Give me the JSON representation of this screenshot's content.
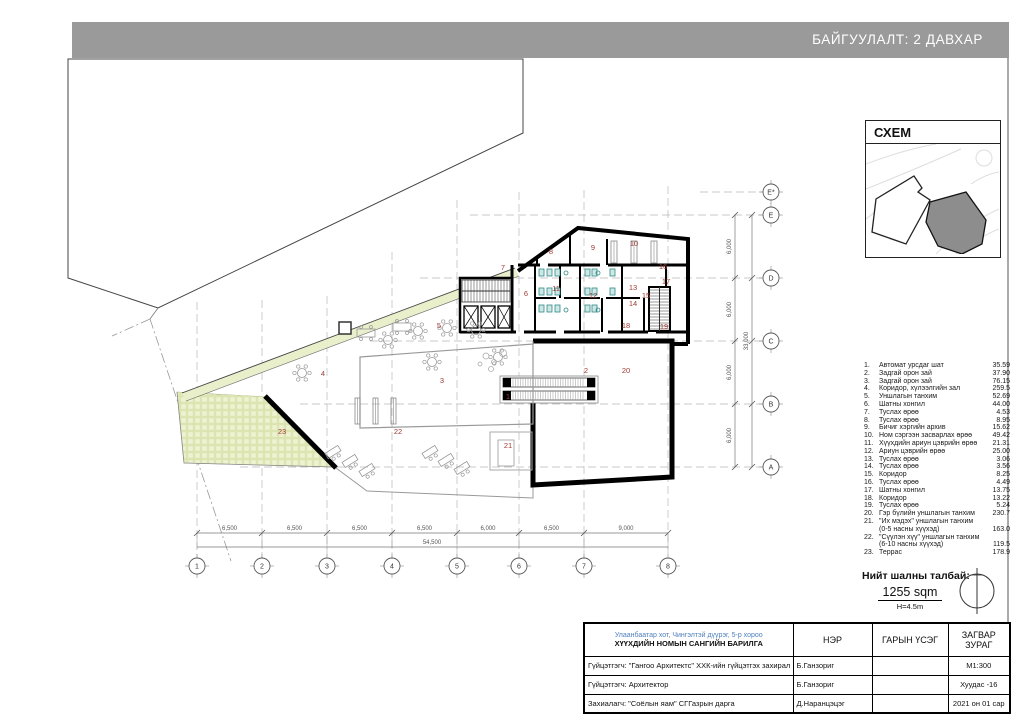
{
  "header": {
    "title": "БАЙГУУЛАЛТ:  2 ДАВХАР"
  },
  "schem": {
    "title": "СХЕМ"
  },
  "legend": {
    "items": [
      {
        "no": "1.",
        "name": "Автомат урсдаг шат",
        "area": "35.59"
      },
      {
        "no": "2.",
        "name": "Задгай орон зай",
        "area": "37.90"
      },
      {
        "no": "3.",
        "name": "Задгай орон зай",
        "area": "76.15"
      },
      {
        "no": "4.",
        "name": "Коридор, хүлээлгийн зал",
        "area": "259.5"
      },
      {
        "no": "5.",
        "name": "Уншлагын танхим",
        "area": "52.69"
      },
      {
        "no": "6.",
        "name": "Шатны хонгил",
        "area": "44.00"
      },
      {
        "no": "7.",
        "name": "Туслах өрөө",
        "area": "4.53"
      },
      {
        "no": "8.",
        "name": "Туслах өрөө",
        "area": "8.95"
      },
      {
        "no": "9.",
        "name": "Бичиг хэргийн архив",
        "area": "15.62"
      },
      {
        "no": "10.",
        "name": "Ном сэргээн засварлах өрөө",
        "area": "49.42"
      },
      {
        "no": "11.",
        "name": "Хүүхдийн ариун цэврийн өрөө",
        "area": "21.31"
      },
      {
        "no": "12.",
        "name": "Ариун цэврийн өрөө",
        "area": "25.00"
      },
      {
        "no": "13.",
        "name": "Туслах өрөө",
        "area": "3.06"
      },
      {
        "no": "14.",
        "name": "Туслах өрөө",
        "area": "3.56"
      },
      {
        "no": "15.",
        "name": "Коридор",
        "area": "8.25"
      },
      {
        "no": "16.",
        "name": "Туслах өрөө",
        "area": "4.49"
      },
      {
        "no": "17.",
        "name": "Шатны хонгил",
        "area": "13.75"
      },
      {
        "no": "18.",
        "name": "Коридор",
        "area": "13.22"
      },
      {
        "no": "19.",
        "name": "Туслах өрөө",
        "area": "5.24"
      },
      {
        "no": "20.",
        "name": "Гэр бүлийн уншлагын танхим",
        "area": "230.7"
      },
      {
        "no": "21.",
        "name": "\"Их мэдэх\" уншлагын танхим",
        "sub": "(0-5 насны хүүхэд)",
        "area": "163.0"
      },
      {
        "no": "22.",
        "name": "\"Сүүлэн хүү\" уншлагын танхим",
        "sub": "(6-10 насны хүүхэд)",
        "area": "119.5"
      },
      {
        "no": "23.",
        "name": "Террас",
        "area": "178.9"
      }
    ]
  },
  "total": {
    "label": "Нийт шалны талбай:",
    "area": "1255 sqm",
    "height": "H=4.5m"
  },
  "titleblock": {
    "address": "Улаанбаатар хот, Чингэлтэй дүүрэг, 5-р хороо",
    "project": "ХҮҮХДИЙН НОМЫН САНГИЙН БАРИЛГА",
    "col_name": "НЭР",
    "col_sign": "ГАРЫН ҮСЭГ",
    "col_type1": "ЗАГВАР",
    "col_type2": "ЗУРАГ",
    "rows": [
      {
        "role": "Гүйцэтгэгч: \"Гангоо Архитектс\" ХХК-ийн гүйцэтгэх захирал",
        "name": "Б.Ганзориг",
        "sign": "",
        "right": "М1:300"
      },
      {
        "role": "Гүйцэтгэгч: Архитектор",
        "name": "Б.Ганзориг",
        "sign": "",
        "right": "Хуудас -16"
      },
      {
        "role": "Захиалагч: \"Соёлын яам\" СГГазрын дарга",
        "name": "Д.Наранцэцэг",
        "sign": "",
        "right": "2021 он 01 сар"
      }
    ]
  },
  "plan": {
    "grid_cols": [
      {
        "label": "1",
        "x": 197
      },
      {
        "label": "2",
        "x": 262
      },
      {
        "label": "3",
        "x": 327
      },
      {
        "label": "4",
        "x": 392
      },
      {
        "label": "5",
        "x": 457
      },
      {
        "label": "6",
        "x": 519
      },
      {
        "label": "7",
        "x": 584
      },
      {
        "label": "8",
        "x": 668
      }
    ],
    "grid_rows": [
      {
        "label": "E*",
        "y": 192
      },
      {
        "label": "E",
        "y": 215
      },
      {
        "label": "D",
        "y": 278
      },
      {
        "label": "C",
        "y": 341
      },
      {
        "label": "B",
        "y": 404
      },
      {
        "label": "A",
        "y": 467
      }
    ],
    "dims_bottom": [
      "6,500",
      "6,500",
      "6,500",
      "6,500",
      "6,000",
      "6,500",
      "9,000"
    ],
    "dim_total_bottom": "54,500",
    "dims_right": [
      "6,000",
      "6,000",
      "6,000",
      "6,000"
    ],
    "dim_total_right": "33,000",
    "room_labels": [
      {
        "no": "1",
        "x": 508,
        "y": 399
      },
      {
        "no": "2",
        "x": 586,
        "y": 373
      },
      {
        "no": "3",
        "x": 442,
        "y": 383
      },
      {
        "no": "4",
        "x": 323,
        "y": 376
      },
      {
        "no": "5",
        "x": 439,
        "y": 328
      },
      {
        "no": "6",
        "x": 526,
        "y": 296
      },
      {
        "no": "7",
        "x": 503,
        "y": 270
      },
      {
        "no": "8",
        "x": 551,
        "y": 254
      },
      {
        "no": "9",
        "x": 593,
        "y": 250
      },
      {
        "no": "10",
        "x": 634,
        "y": 246
      },
      {
        "no": "11",
        "x": 556,
        "y": 291
      },
      {
        "no": "12",
        "x": 593,
        "y": 298
      },
      {
        "no": "13",
        "x": 633,
        "y": 290
      },
      {
        "no": "14",
        "x": 633,
        "y": 306
      },
      {
        "no": "15",
        "x": 646,
        "y": 298
      },
      {
        "no": "16",
        "x": 663,
        "y": 269
      },
      {
        "no": "17",
        "x": 666,
        "y": 284
      },
      {
        "no": "18",
        "x": 626,
        "y": 328
      },
      {
        "no": "19",
        "x": 664,
        "y": 329
      },
      {
        "no": "20",
        "x": 626,
        "y": 373
      },
      {
        "no": "21",
        "x": 508,
        "y": 448
      },
      {
        "no": "22",
        "x": 398,
        "y": 434
      },
      {
        "no": "23",
        "x": 282,
        "y": 434
      }
    ]
  },
  "colors": {
    "header_bg": "#9a9a9a",
    "room_label": "#a03c35",
    "terrace_fill": "#edf2d2",
    "fixture_teal": "#2e8b87",
    "address_blue": "#4f81bd",
    "wall_black": "#000000"
  }
}
